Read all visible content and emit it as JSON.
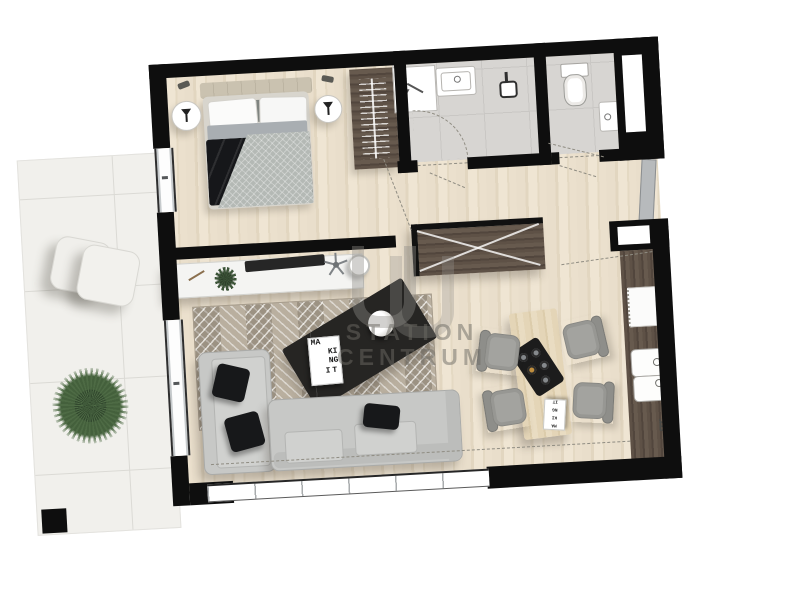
{
  "title": "Apartment floor plan – furnished top view",
  "watermark": {
    "logo": "double-arch-monogram",
    "line1": "STATION",
    "line2": "CENTRUM"
  },
  "poster": {
    "lines": [
      "MA",
      "KI",
      "NG",
      "IT"
    ]
  },
  "card": {
    "lines": [
      "MA",
      "KI",
      "NG",
      "IT"
    ]
  },
  "colors": {
    "wall": "#0e0e0e",
    "wood_floor": "#e8dcc6",
    "bath_tile": "#d7d5d2",
    "terrace_tile": "#f1f0ec",
    "dark_wood": "#5e5146",
    "sofa": "#c7c8c6",
    "pillow": "#17181a",
    "rug": "#b9af9f",
    "hob_brass": "#bf8e3e",
    "plant": "#4e6b45",
    "watermark": "#6c6963"
  },
  "rooms": [
    {
      "name": "terrace",
      "furniture": [
        "lounge-chair",
        "lounge-chair",
        "plant",
        "column"
      ]
    },
    {
      "name": "bedroom",
      "furniture": [
        "double-bed",
        "nightstand-left",
        "nightstand-right",
        "wardrobe",
        "headboard"
      ]
    },
    {
      "name": "bathroom",
      "furniture": [
        "shower",
        "washbasin",
        "shower-head",
        "door-swing"
      ]
    },
    {
      "name": "wc",
      "furniture": [
        "toilet",
        "hand-basin"
      ]
    },
    {
      "name": "hallway",
      "furniture": [
        "entry-closet",
        "entrance-door"
      ]
    },
    {
      "name": "living-room",
      "furniture": [
        "console-desk",
        "office-chair",
        "stool",
        "rug",
        "corner-sofa",
        "coffee-table",
        "poster"
      ]
    },
    {
      "name": "kitchen-dining",
      "furniture": [
        "dining-table",
        "hob",
        "dining-chair",
        "dining-chair",
        "dining-chair",
        "dining-chair",
        "kitchen-counter",
        "double-sink",
        "appliance"
      ]
    }
  ]
}
